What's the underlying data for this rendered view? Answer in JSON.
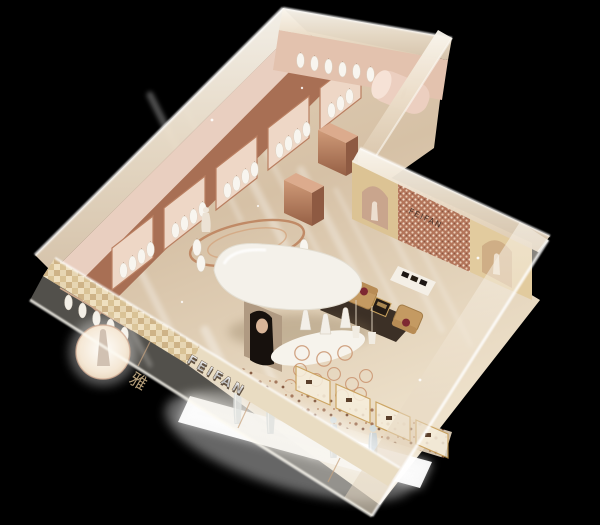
{
  "scene": {
    "kind": "3d-interior-render",
    "view": "isometric bird's-eye model on black backdrop",
    "subject": "L-shaped fashion boutique exhibition model"
  },
  "signage": {
    "storefront_sign": "FEIFAN",
    "feature_wall_logo": "FEIFAN",
    "entrance_glyph": "雅"
  },
  "palette": {
    "background": "#000000",
    "floor": "#ddcab1",
    "frosted_wall": "#f2ebdd",
    "copper": "#b3785a",
    "gold_wall": "#dcc394",
    "mosaic_rose": "#b3755a",
    "canopy_white": "#f4f1ea",
    "armchair_camel": "#c49a62",
    "cushion_red": "#7e2832",
    "rug_brown": "#33271d",
    "mannequin_crystal": "#c3ced4",
    "light_glow": "#ffffff"
  },
  "objects": {
    "garment_bays": "copper wall bays with hanging white garments",
    "back_rail": "back wall garment rail with display drum",
    "ring_rack": "circular copper hanging rack",
    "island": "white canopy island with portrait column and mannequin plinth",
    "lounge": "two camel armchairs, dark coffee table, brown rug",
    "bag_table": "white table with dark checkered bags",
    "feature_wall": "rose-gold mosaic wall with logo and arched niches",
    "front_window": "lit display platform with translucent mannequins",
    "spotlight_niche": "circular lit niche with mannequin near entrance",
    "glass_cases": "gold framed display cases along right wall"
  }
}
